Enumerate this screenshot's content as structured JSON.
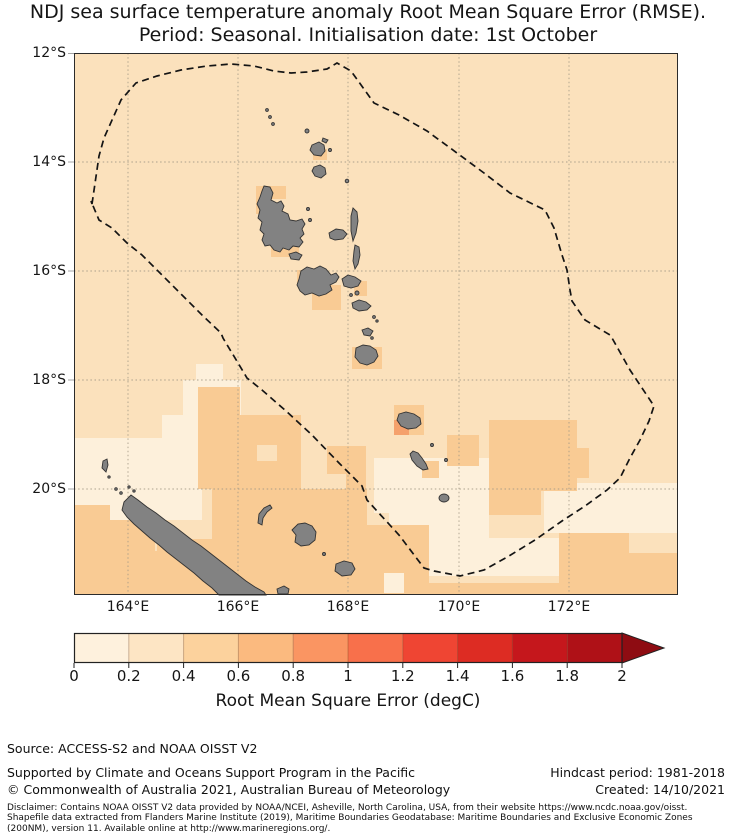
{
  "title": {
    "line1": "NDJ sea surface temperature anomaly Root Mean Square Error (RMSE).",
    "line2": "Period: Seasonal. Initialisation date: 1st October"
  },
  "map": {
    "lat_ticks": [
      "12°S",
      "14°S",
      "16°S",
      "18°S",
      "20°S"
    ],
    "lon_ticks": [
      "164°E",
      "166°E",
      "168°E",
      "170°E",
      "172°E"
    ],
    "land_color": "#828282",
    "boundary_style": "dashed black EEZ outline"
  },
  "colorbar": {
    "label": "Root Mean Square Error (degC)",
    "ticks": [
      "0",
      "0.2",
      "0.4",
      "0.6",
      "0.8",
      "1",
      "1.2",
      "1.4",
      "1.6",
      "1.8",
      "2"
    ],
    "segment_colors": [
      "#FEF1DD",
      "#FDE5C4",
      "#FCD29D",
      "#FBBA7F",
      "#FA9562",
      "#F8704B",
      "#EF4533",
      "#DD2C23",
      "#C5171C",
      "#AF1117"
    ],
    "arrow_color": "#8E0C12",
    "extend": "max"
  },
  "footer": {
    "source": "Source: ACCESS-S2 and NOAA OISST V2",
    "supported": "Supported by Climate and Oceans Support Program in the Pacific",
    "copyright": "© Commonwealth of Australia 2021, Australian Bureau of Meteorology",
    "hindcast": "Hindcast period: 1981-2018",
    "created": "Created: 14/10/2021",
    "disclaimer_lines": [
      "Disclaimer: Contains NOAA OISST V2 data provided by NOAA/NCEI, Asheville, North Carolina, USA, from their website https://www.ncdc.noaa.gov/oisst.",
      "Shapefile data extracted from Flanders Marine Institute (2019), Maritime Boundaries Geodatabase: Maritime Boundaries and Exclusive Economic Zones",
      "(200NM), version 11. Available online at http://www.marineregions.org/."
    ]
  },
  "chart_data": {
    "type": "heatmap",
    "title": "NDJ sea surface temperature anomaly Root Mean Square Error (RMSE).",
    "subtitle": "Period: Seasonal. Initialisation date: 1st October",
    "region": "Vanuatu EEZ and surrounds, approx. 163°E–174°E, 12°S–22°S",
    "x_ticks": [
      "164°E",
      "166°E",
      "168°E",
      "170°E",
      "172°E"
    ],
    "y_ticks": [
      "12°S",
      "14°S",
      "16°S",
      "18°S",
      "20°S"
    ],
    "grid": true,
    "colorbar": {
      "label": "Root Mean Square Error (degC)",
      "ticks": [
        0,
        0.2,
        0.4,
        0.6,
        0.8,
        1,
        1.2,
        1.4,
        1.6,
        1.8,
        2
      ],
      "range": [
        0,
        2
      ],
      "extend": "max",
      "units": "degC"
    },
    "value_bins": [
      {
        "range": [
          0.0,
          0.2
        ],
        "color": "#FDF0DB"
      },
      {
        "range": [
          0.2,
          0.4
        ],
        "color": "#FBE1BC"
      },
      {
        "range": [
          0.4,
          0.6
        ],
        "color": "#F9CB94"
      },
      {
        "range": [
          0.6,
          0.8
        ],
        "color": "#F5A16C"
      }
    ],
    "observations": [
      {
        "area": "Open ocean across most of the Vanuatu EEZ",
        "rmse_range": [
          0.2,
          0.4
        ]
      },
      {
        "area": "Band west of 166°E near 18°S–20°S and south-central area near the EEZ southern vertex (169°E–172°E, 20°S–22°S)",
        "rmse_range": [
          0.0,
          0.2
        ]
      },
      {
        "area": "Coastal cells around Vanuatu islands (Vanua Lava, Espiritu Santo, Malekula, Ambrym, Efate, Erromango, Tanna)",
        "rmse_range": [
          0.4,
          0.6
        ]
      },
      {
        "area": "South-west corner, seas around New Caledonia and Loyalty Islands, patch near 19°S–20°S 170°E–172°E, and south-east corner",
        "rmse_range": [
          0.4,
          0.6
        ]
      },
      {
        "area": "Single cell immediately south-west of Erromango",
        "rmse_range": [
          0.6,
          0.8
        ]
      }
    ],
    "overlays": [
      "Dashed black EEZ boundary polygon",
      "Grey land: Vanuatu archipelago, New Caledonia (Grande Terre), Loyalty Islands"
    ]
  }
}
